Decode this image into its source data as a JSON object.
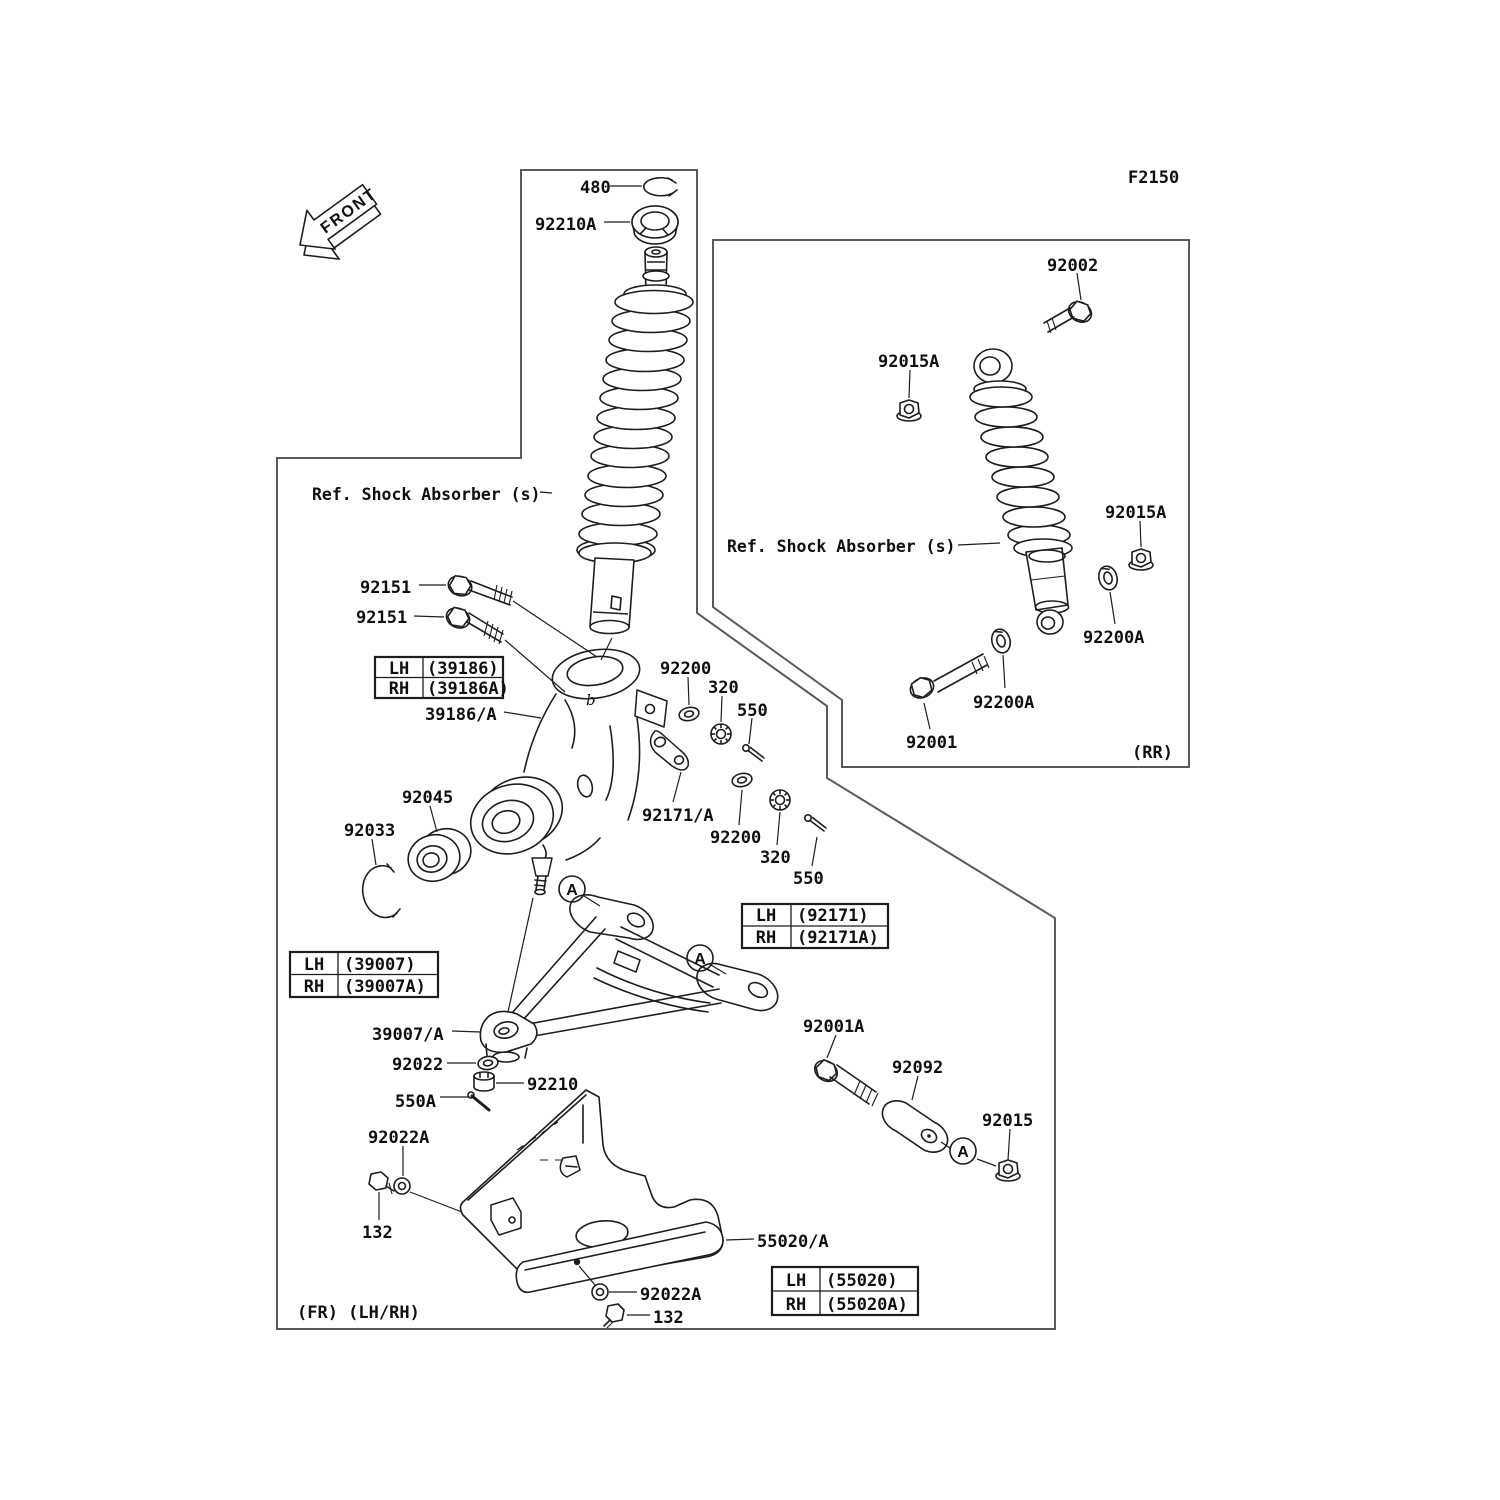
{
  "title_code": "F2150",
  "orientation": {
    "front_arrow": "FRONT"
  },
  "view_markers": {
    "front": "(FR) (LH/RH)",
    "rear": "(RR)"
  },
  "ref_notes": {
    "front_shock": "Ref. Shock Absorber (s)",
    "rear_shock": "Ref. Shock Absorber (s)"
  },
  "callouts": {
    "a": "A",
    "b": "b"
  },
  "labels": {
    "snap_ring": "480",
    "locknut_top": "92210A",
    "bolt_rear_upper": "92002",
    "nut_rear_upper": "92015A",
    "nut_rear_side": "92015A",
    "bolt_knuckle_1": "92151",
    "bolt_knuckle_2": "92151",
    "knuckle": "39186/A",
    "washer_tierod_upper": "92200",
    "nut_castle_upper": "320",
    "pin_cotter_upper": "550",
    "tierod_arm": "92171/A",
    "washer_tierod_lower": "92200",
    "nut_castle_lower": "320",
    "pin_cotter_lower": "550",
    "bearing": "92045",
    "circlip": "92033",
    "washer_rear_upper": "92200A",
    "washer_rear_lower": "92200A",
    "bolt_rear_lower": "92001",
    "susp_arm": "39007/A",
    "washer_balljoint": "92022",
    "nut_castle_balljoint": "92210",
    "pin_cotter_balljoint": "550A",
    "washer_guard_front": "92022A",
    "bolt_guard_front": "132",
    "bolt_arm_pivot": "92001A",
    "bushing_arm": "92092",
    "nut_arm_pivot": "92015",
    "guard": "55020/A",
    "washer_guard_rear": "92022A",
    "bolt_guard_rear": "132"
  },
  "variant_tables": [
    {
      "rows": [
        [
          "LH",
          "(39186)"
        ],
        [
          "RH",
          "(39186A)"
        ]
      ]
    },
    {
      "rows": [
        [
          "LH",
          "(92171)"
        ],
        [
          "RH",
          "(92171A)"
        ]
      ]
    },
    {
      "rows": [
        [
          "LH",
          "(39007)"
        ],
        [
          "RH",
          "(39007A)"
        ]
      ]
    },
    {
      "rows": [
        [
          "LH",
          "(55020)"
        ],
        [
          "RH",
          "(55020A)"
        ]
      ]
    }
  ],
  "colors": {
    "line": "#1d1d1d",
    "frame": "#5a5a5a",
    "background": "#ffffff"
  }
}
